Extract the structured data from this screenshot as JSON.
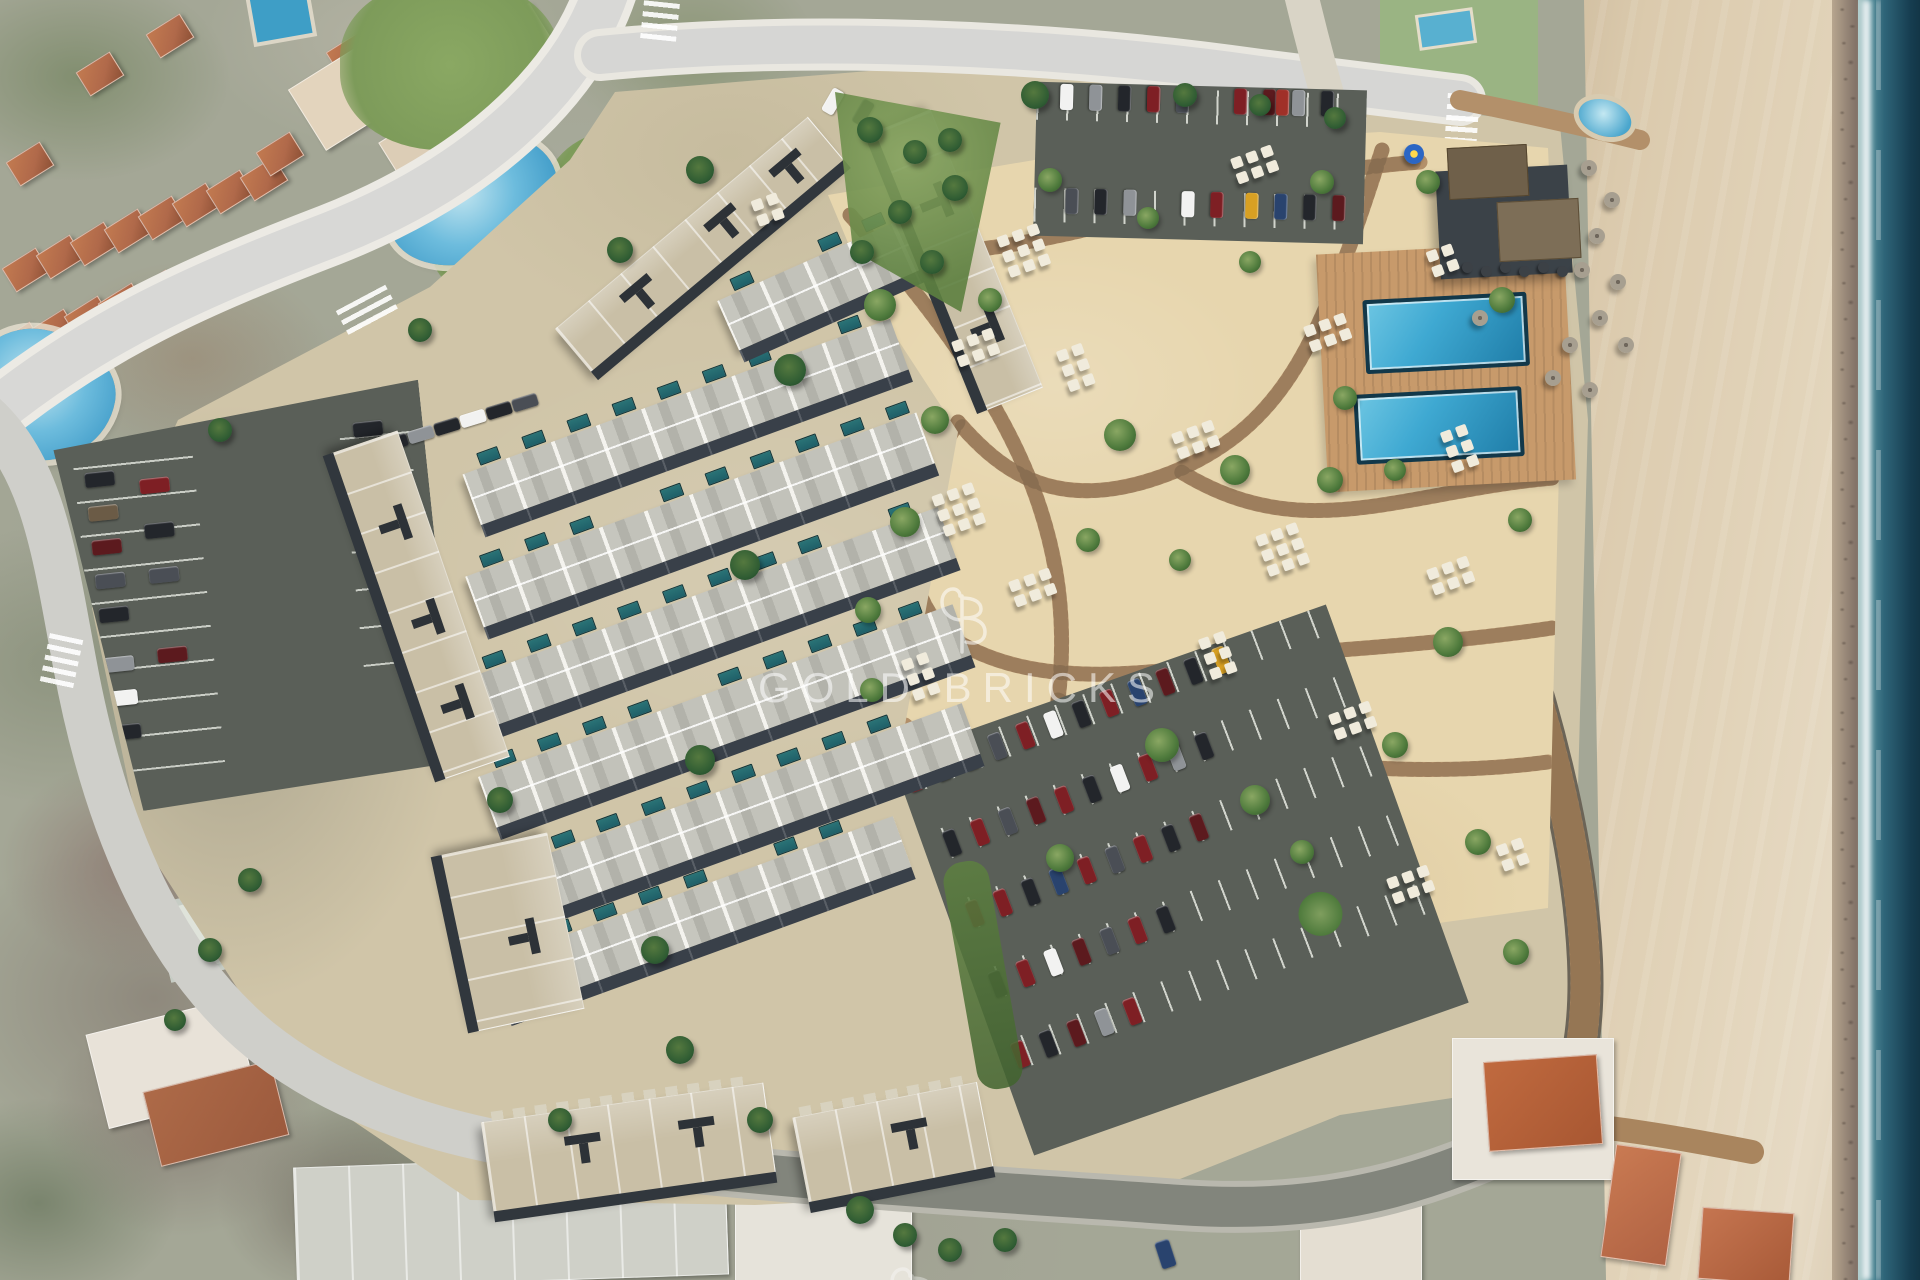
{
  "title": "Aerial masterplan render of a beachfront townhouse resort",
  "watermark": {
    "text": "GOLD BRICKS",
    "logo_name": "gold-bricks-monogram",
    "color": "#ffffff"
  },
  "palette": {
    "neighborhood_base": "#a4a796",
    "sea_deep": "#163d50",
    "sea_edge": "#2e6478",
    "wet_sand": "#8d7d70",
    "beach_sand": "#dccbae",
    "plot_hardscape": "#d0c5a8",
    "garden_sand": "#e7d6ae",
    "boardwalk_wood": "#b08b63",
    "deck_wood": "#c79a6b",
    "pool_water": "#3fa9d2",
    "pool_water_deep": "#1f7da8",
    "plunge_pool": "#24646b",
    "roof_light": "#c2c2ba",
    "facade_shadow": "#394049",
    "block_roof": "#c9bfa6",
    "asphalt": "#5a5f58",
    "road_light": "#d7d7d6",
    "road_dark": "#82857c",
    "lawn_green": "#7d9b5a",
    "shrub_green": "#4e7a3c",
    "palm_green": "#2f5c33",
    "terracotta_roof": "#b0694a"
  },
  "car_colors": [
    "#23262b",
    "#4a4e55",
    "#8f9397",
    "#c9cbcd",
    "#f2f2f1",
    "#7e1f24",
    "#a03028",
    "#5c1a1e",
    "#d8a023",
    "#c87f1e",
    "#29436e",
    "#6b5b46"
  ],
  "regions": [
    "sea",
    "shoreline-surf",
    "sandy-beach",
    "beach-promenade",
    "resort-plot",
    "townhouse-rows",
    "plunge-pools",
    "perimeter-apartment-blocks",
    "landscaped-sand-garden",
    "boardwalk-paths",
    "parasol-clusters",
    "wooden-pool-deck",
    "swimming-pool-1",
    "swimming-pool-2",
    "beach-club",
    "straw-parasols",
    "parking-north",
    "parking-east",
    "parking-west",
    "access-roads",
    "crosswalks",
    "neighbouring-villas",
    "lagoon-pool-north",
    "lagoon-pool-west",
    "scrub-plot-south-west",
    "watermark"
  ],
  "counts": {
    "main_pools": 2,
    "lagoon_pools": 2,
    "townhouse_rows": 7,
    "parking_lots": 3
  }
}
